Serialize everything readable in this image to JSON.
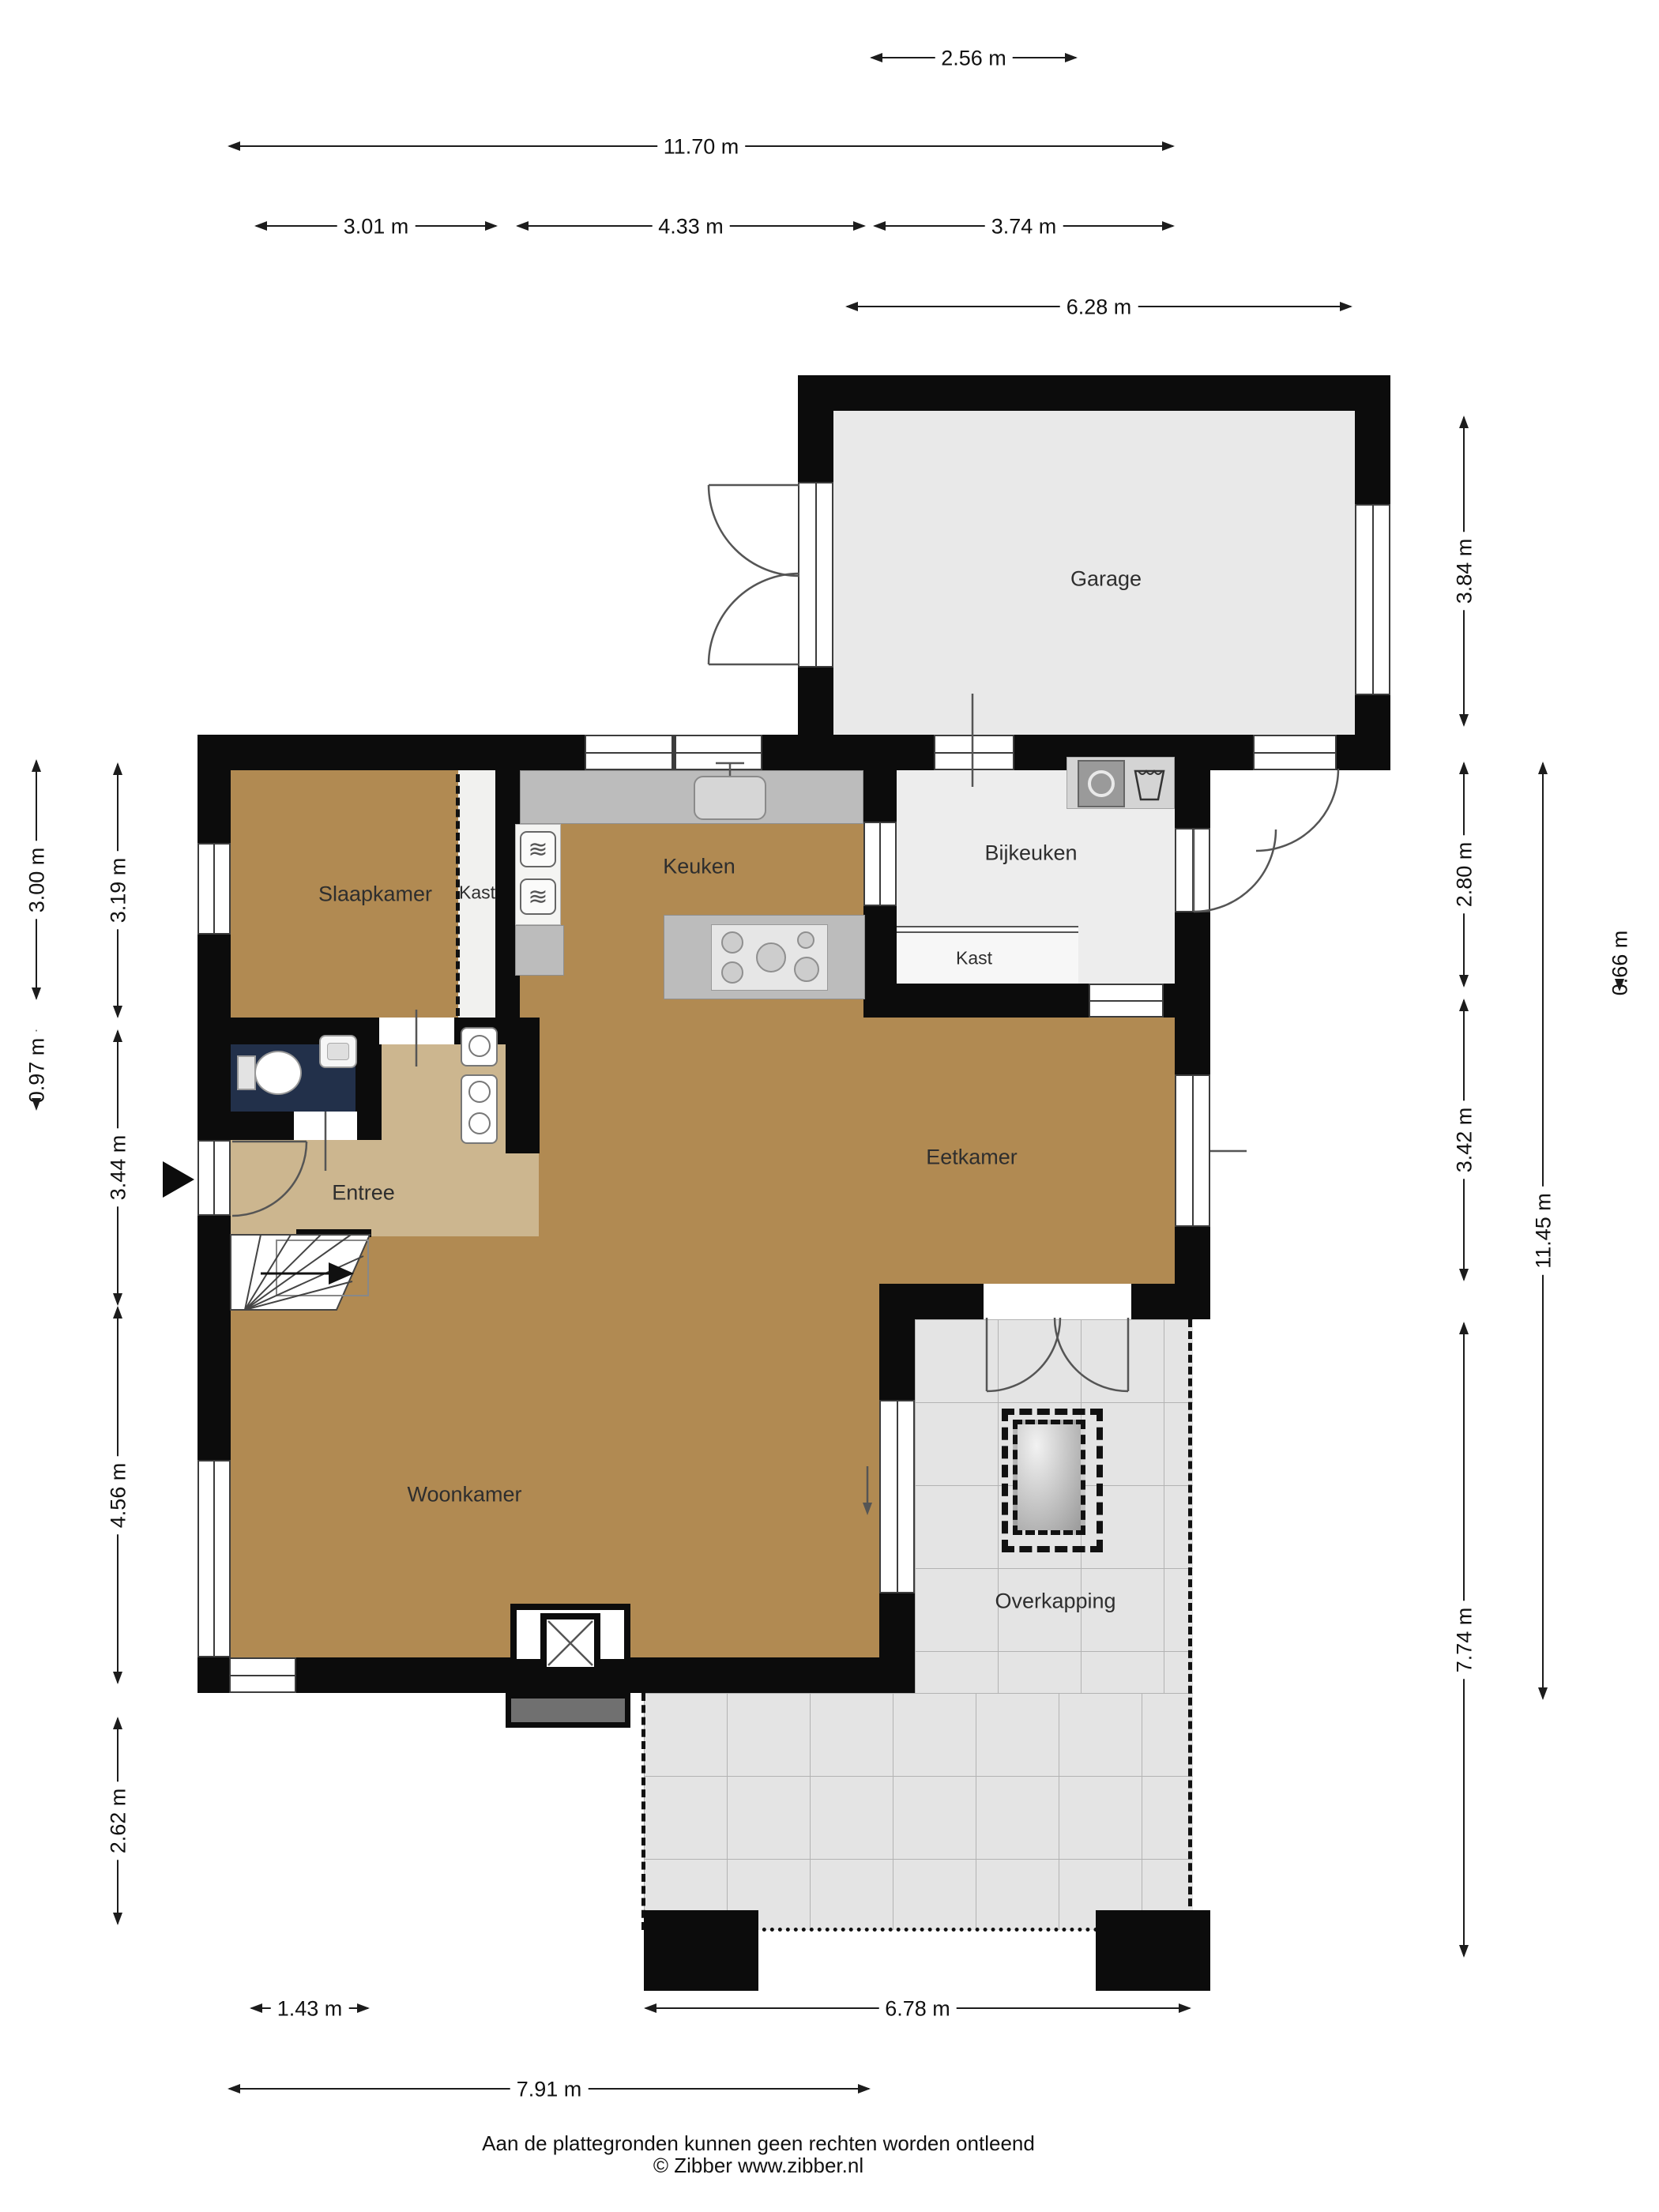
{
  "rooms": {
    "garage": "Garage",
    "slaapkamer": "Slaapkamer",
    "kast_slaapkamer": "Kast",
    "keuken": "Keuken",
    "bijkeuken": "Bijkeuken",
    "kast_bijkeuken": "Kast",
    "eetkamer": "Eetkamer",
    "entree": "Entree",
    "woonkamer": "Woonkamer",
    "overkapping": "Overkapping"
  },
  "dimensions": {
    "top": {
      "d256": "2.56 m",
      "d1170": "11.70 m",
      "d301": "3.01 m",
      "d433": "4.33 m",
      "d374": "3.74 m",
      "d628": "6.28 m"
    },
    "left": {
      "d300": "3.00 m",
      "d097": "0.97 m",
      "d319": "3.19 m",
      "d344": "3.44 m",
      "d456": "4.56 m",
      "d262": "2.62 m"
    },
    "right": {
      "d384": "3.84 m",
      "d280": "2.80 m",
      "d342": "3.42 m",
      "d774": "7.74 m",
      "d1145": "11.45 m",
      "d066": "0.66 m"
    },
    "bottom": {
      "d143": "1.43 m",
      "d678": "6.78 m",
      "d791": "7.91 m"
    }
  },
  "footer": {
    "line1": "Aan de plattegronden kunnen geen rechten worden ontleend",
    "line2": "© Zibber www.zibber.nl"
  },
  "colors": {
    "wall": "#0c0c0c",
    "floor_wood": "#b18a52",
    "floor_entree": "#ccb68f",
    "floor_toilet": "#22304a",
    "floor_garage": "#e9e9e9",
    "floor_bijkeuken": "#ededed",
    "floor_overkapping": "#e4e4e4",
    "counter": "#bcbcbc"
  },
  "icons": {
    "oven_glyph": "≋"
  }
}
